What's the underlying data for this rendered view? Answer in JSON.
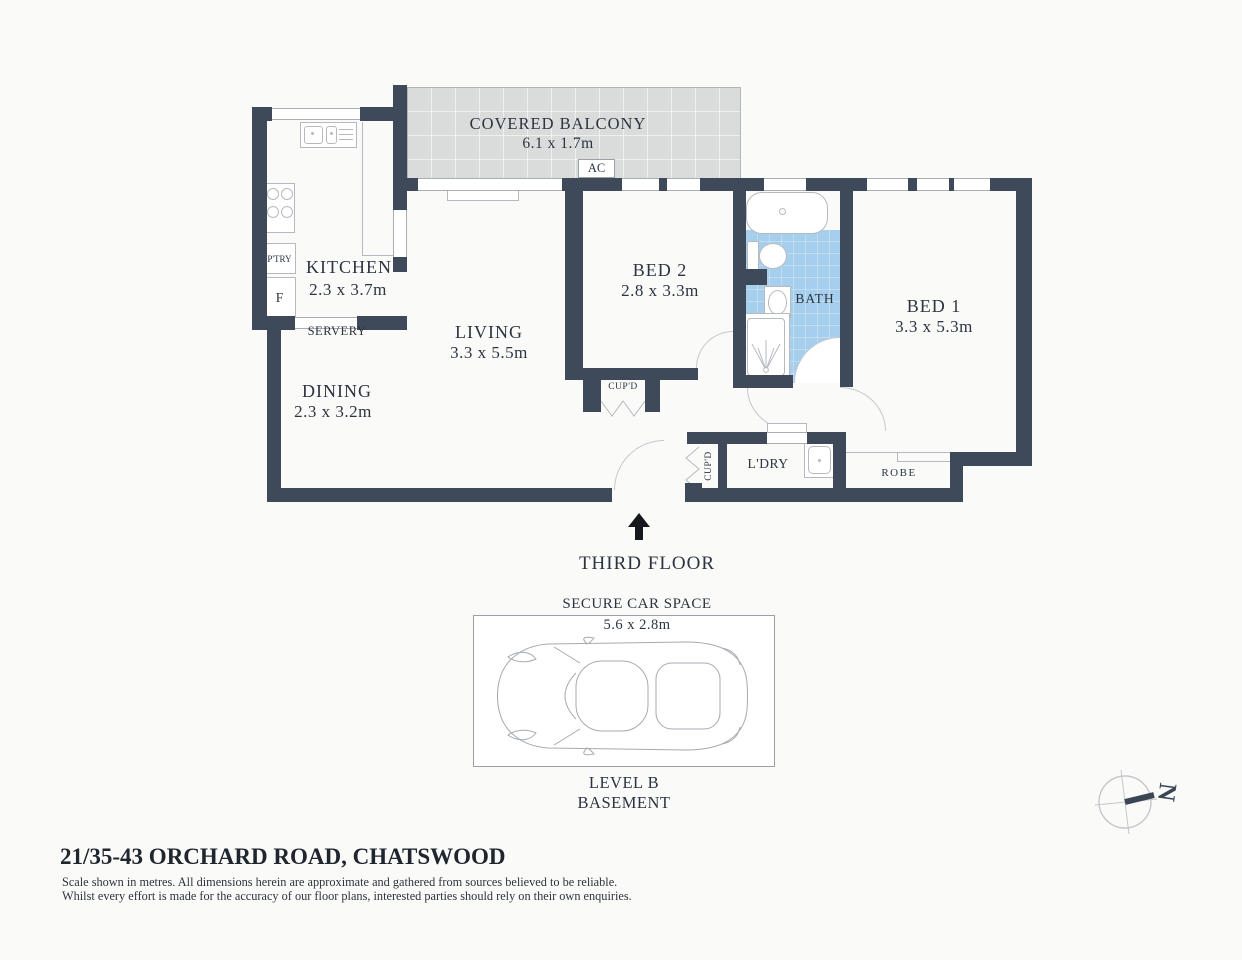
{
  "colors": {
    "wall": "#3e4a59",
    "bath_fill": "#a6cfee",
    "balcony_fill": "#dadbdb",
    "ink": "#2b3440"
  },
  "plan": {
    "floor_label": "THIRD FLOOR",
    "balcony": {
      "name": "COVERED BALCONY",
      "dims": "6.1 x 1.7m",
      "ac": "AC"
    },
    "kitchen": {
      "name": "KITCHEN",
      "dims": "2.3 x 3.7m",
      "pantry": "P'TRY",
      "fridge": "F",
      "servery": "SERVERY"
    },
    "living": {
      "name": "LIVING",
      "dims": "3.3 x 5.5m",
      "cupboard": "CUP'D"
    },
    "dining": {
      "name": "DINING",
      "dims": "2.3 x 3.2m"
    },
    "bed2": {
      "name": "BED 2",
      "dims": "2.8 x 3.3m"
    },
    "bed1": {
      "name": "BED 1",
      "dims": "3.3 x 5.3m",
      "robe": "ROBE"
    },
    "bath": {
      "name": "BATH"
    },
    "hall": {
      "cupboard": "CUP'D",
      "laundry": "L'DRY"
    }
  },
  "car_space": {
    "title": "SECURE CAR SPACE",
    "dims": "5.6 x 2.8m",
    "level1": "LEVEL B",
    "level2": "BASEMENT"
  },
  "compass": {
    "north": "N"
  },
  "footer": {
    "address": "21/35-43 ORCHARD ROAD, CHATSWOOD",
    "disclaimer1": "Scale shown in metres. All dimensions herein are approximate and gathered from sources believed to be  reliable.",
    "disclaimer2": "Whilst every effort is made for the accuracy of our floor plans, interested parties should rely on their own enquiries."
  }
}
